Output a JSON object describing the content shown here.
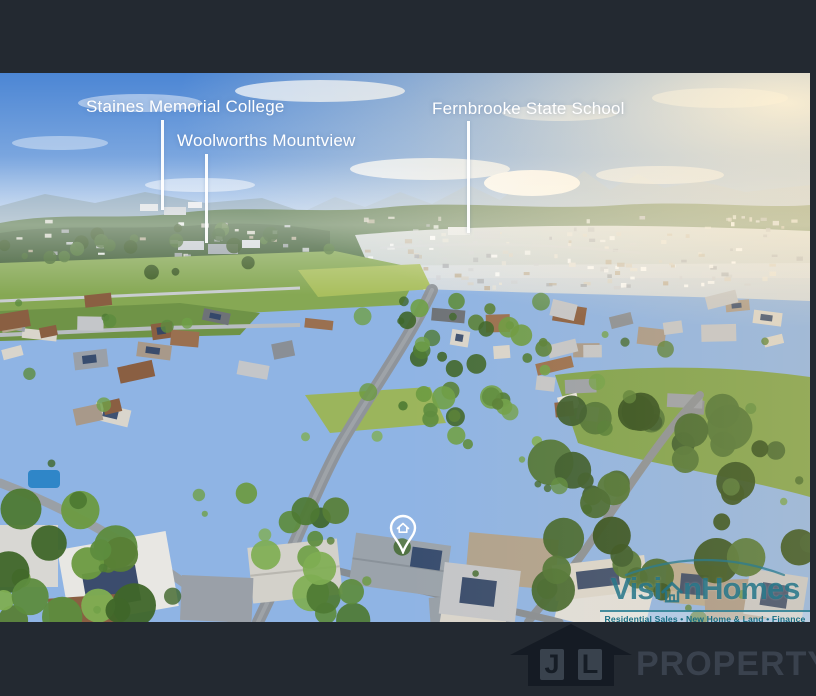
{
  "annotations": {
    "pois": [
      {
        "label": "Staines Memorial College"
      },
      {
        "label": "Woolworths Mountview"
      },
      {
        "label": "Fernbrooke State School"
      }
    ],
    "pin_icon": "property-location-pin"
  },
  "watermark": {
    "brand_full": "VisionHomes",
    "brand_segments": {
      "before_icon": "Visi",
      "after_icon": "nHomes"
    },
    "icon": "house-icon",
    "tagline": "Residential Sales • New Home & Land • Finance",
    "brand_color": "#2d8598"
  },
  "footer": {
    "logo_icon": "house-logo",
    "logo_letter_1": "J",
    "logo_letter_2": "L",
    "wordmark": "PROPERTY"
  },
  "colors": {
    "page_background": "#232931",
    "label_text": "#ffffff",
    "watermark_teal": "#2d8598",
    "footer_text": "#3a424e"
  }
}
